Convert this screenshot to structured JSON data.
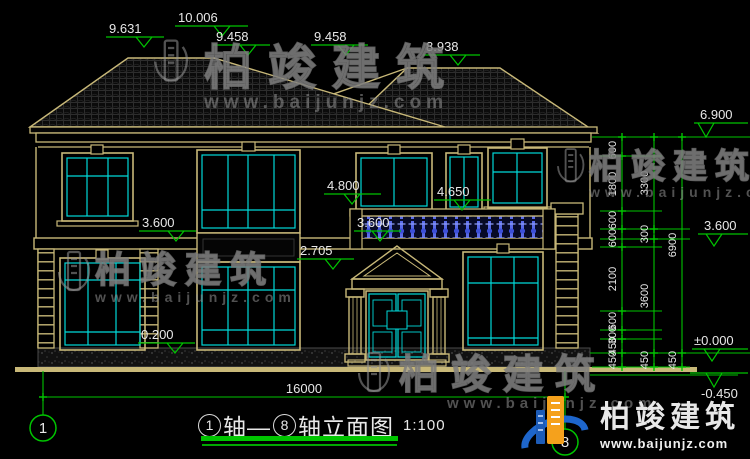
{
  "drawing": {
    "type": "architectural-elevation",
    "background": "#000000"
  },
  "watermark": {
    "brand": "柏竣建筑",
    "url": "www.baijunjz.com"
  },
  "colors": {
    "outline_tan": "#C8B878",
    "glass_cyan": "#00D9D9",
    "dimension_green": "#00C400",
    "text_white": "#E8E8E8",
    "baluster_blue": "#4355DC",
    "logo_blue": "#1E66CC",
    "logo_orange": "#F5A11C"
  },
  "elevation_marks": {
    "roof": [
      "9.631",
      "10.006",
      "9.458",
      "9.458",
      "8.938"
    ],
    "facade": [
      "3.600",
      "0.200",
      "2.705",
      "4.800",
      "4.650",
      "3.600"
    ],
    "right": [
      "6.900",
      "3.600",
      "±0.000",
      "-0.450"
    ]
  },
  "dimensions": {
    "right_chain_inner": [
      "600",
      "1800",
      "600",
      "600",
      "2100",
      "600",
      "300",
      "450",
      "450"
    ],
    "right_chain_mid": [
      "3300",
      "300",
      "3600",
      "450"
    ],
    "right_chain_outer": [
      "6900",
      "450"
    ],
    "bottom_total": "16000"
  },
  "axes": {
    "start": "1",
    "end": "8"
  },
  "title_block": {
    "axis_start": "1",
    "joiner": "轴—",
    "axis_end": "8",
    "suffix": "轴立面图",
    "scale": "1:100"
  }
}
